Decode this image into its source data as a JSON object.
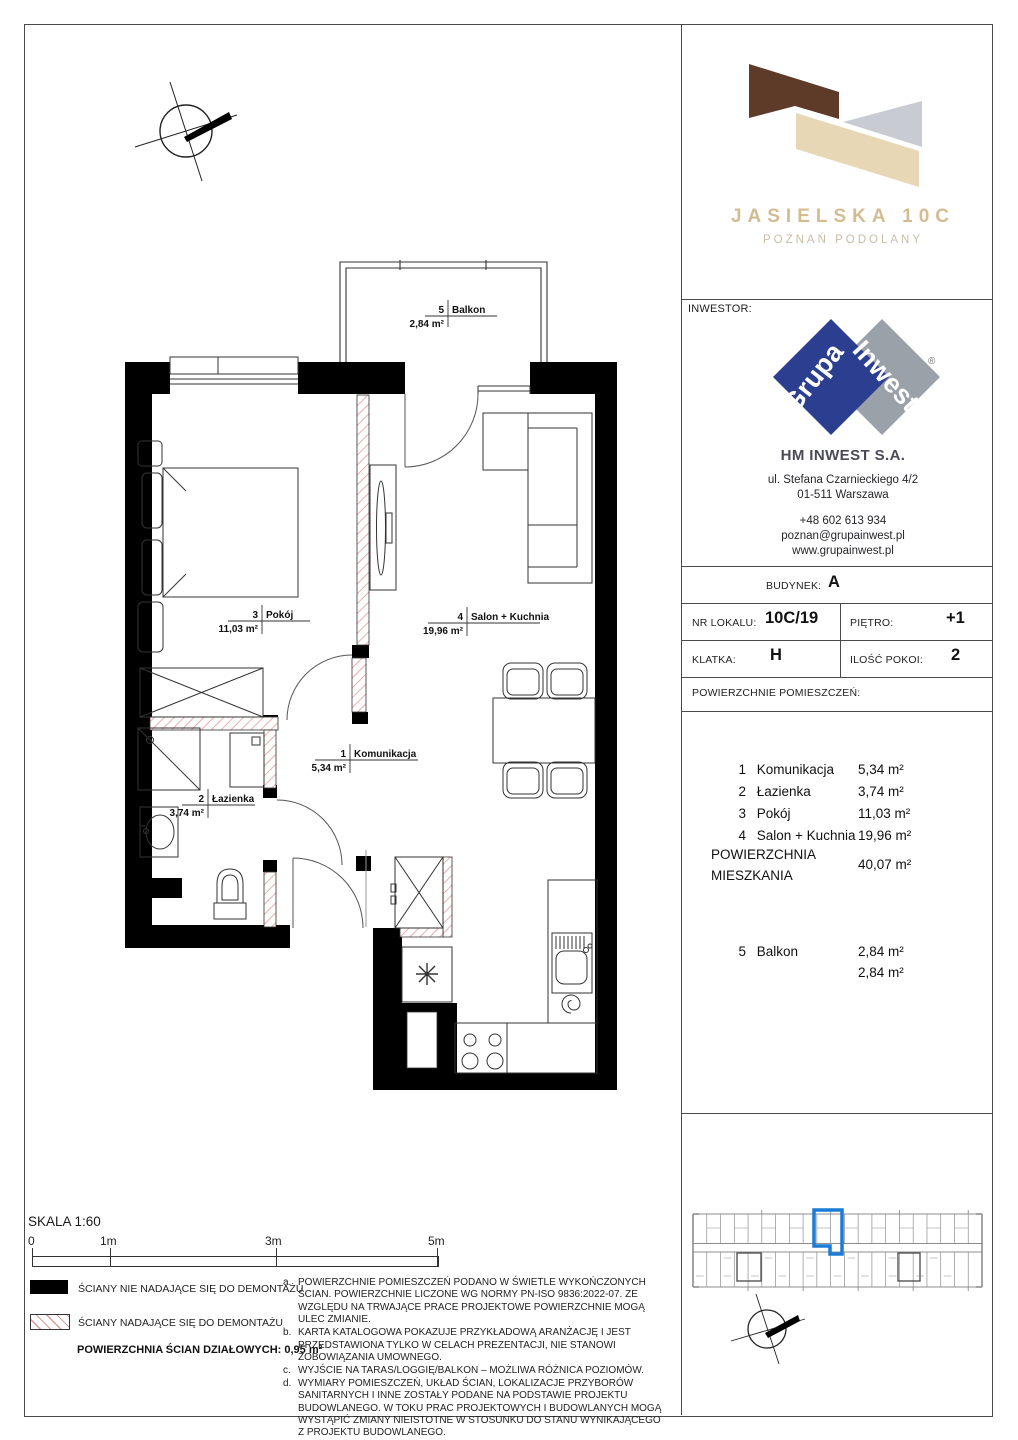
{
  "project": {
    "title": "JASIELSKA 10C",
    "subtitle": "POZNAŃ PODOLANY"
  },
  "investor": {
    "label": "INWESTOR:",
    "logo_word1": "Grupa",
    "logo_word2": "Inwest",
    "registered_mark": "®",
    "name": "HM INWEST S.A.",
    "address_line1": "ul. Stefana Czarnieckiego 4/2",
    "address_line2": "01-511 Warszawa",
    "phone": "+48 602 613 934",
    "email": "poznan@grupainwest.pl",
    "website": "www.grupainwest.pl"
  },
  "unit": {
    "building_label": "BUDYNEK:",
    "building": "A",
    "lokal_label": "NR LOKALU:",
    "lokal": "10C/19",
    "floor_label": "PIĘTRO:",
    "floor": "+1",
    "staircase_label": "KLATKA:",
    "staircase": "H",
    "rooms_count_label": "ILOŚĆ POKOI:",
    "rooms_count": "2",
    "areas_header": "POWIERZCHNIE POMIESZCZEŃ:"
  },
  "areas": {
    "items": [
      {
        "no": "1",
        "name": "Komunikacja",
        "area": "5,34 m²"
      },
      {
        "no": "2",
        "name": "Łazienka",
        "area": "3,74 m²"
      },
      {
        "no": "3",
        "name": "Pokój",
        "area": "11,03 m²"
      },
      {
        "no": "4",
        "name": "Salon + Kuchnia",
        "area": "19,96 m²"
      }
    ],
    "total_label_line1": "POWIERZCHNIA",
    "total_label_line2": "MIESZKANIA",
    "total": "40,07 m²",
    "balcony": {
      "no": "5",
      "name": "Balkon",
      "area": "2,84 m²"
    },
    "balcony_total": "2,84 m²"
  },
  "plan": {
    "balkon": {
      "no": "5",
      "name": "Balkon",
      "area": "2,84 m²"
    },
    "pokoj": {
      "no": "3",
      "name": "Pokój",
      "area": "11,03 m²"
    },
    "salon": {
      "no": "4",
      "name": "Salon + Kuchnia",
      "area": "19,96 m²"
    },
    "komunikacja": {
      "no": "1",
      "name": "Komunikacja",
      "area": "5,34 m²"
    },
    "lazienka": {
      "no": "2",
      "name": "Łazienka",
      "area": "3,74 m²"
    }
  },
  "scale": {
    "label": "SKALA 1:60",
    "ticks": [
      "0",
      "1m",
      "3m",
      "5m"
    ]
  },
  "legend": {
    "solid": "ŚCIANY NIE NADAJĄCE SIĘ DO DEMONTAŻU",
    "hatched": "ŚCIANY NADAJĄCE SIĘ DO DEMONTAŻU",
    "partition": "POWIERZCHNIA ŚCIAN DZIAŁOWYCH: 0,95 m²"
  },
  "notes": [
    {
      "id": "a.",
      "text": "POWIERZCHNIE POMIESZCZEŃ PODANO W ŚWIETLE WYKOŃCZONYCH ŚCIAN. POWIERZCHNIE LICZONE WG NORMY PN-ISO 9836:2022-07. ZE WZGLĘDU NA TRWAJĄCE PRACE PROJEKTOWE POWIERZCHNIE MOGĄ ULEC ZMIANIE."
    },
    {
      "id": "b.",
      "text": "KARTA KATALOGOWA POKAZUJE PRZYKŁADOWĄ ARANŻACJĘ I JEST PRZEDSTAWIONA TYLKO W CELACH PREZENTACJI, NIE STANOWI ZOBOWIĄZANIA UMOWNEGO."
    },
    {
      "id": "c.",
      "text": "WYJŚCIE NA TARAS/LOGGIĘ/BALKON – MOŻLIWA RÓŻNICA POZIOMÓW."
    },
    {
      "id": "d.",
      "text": "WYMIARY POMIESZCZEŃ, UKŁAD ŚCIAN, LOKALIZACJE PRZYBORÓW SANITARNYCH I INNE ZOSTAŁY PODANE NA PODSTAWIE PROJEKTU BUDOWLANEGO. W TOKU PRAC PROJEKTOWYCH I BUDOWLANYCH MOGĄ WYSTĄPIĆ ZMIANY NIEISTOTNE W STOSUNKU DO STANU WYNIKAJĄCEGO Z PROJEKTU BUDOWLANEGO."
    }
  ],
  "colors": {
    "highlight_blue": "#1b7cd6",
    "brand_brown": "#5e3a28",
    "brand_beige": "#e7d7b4",
    "brand_gray": "#c8ccd2",
    "logo_blue": "#2c3e90",
    "logo_gray": "#9ba1a9",
    "hatch_red": "#e39a9a"
  }
}
